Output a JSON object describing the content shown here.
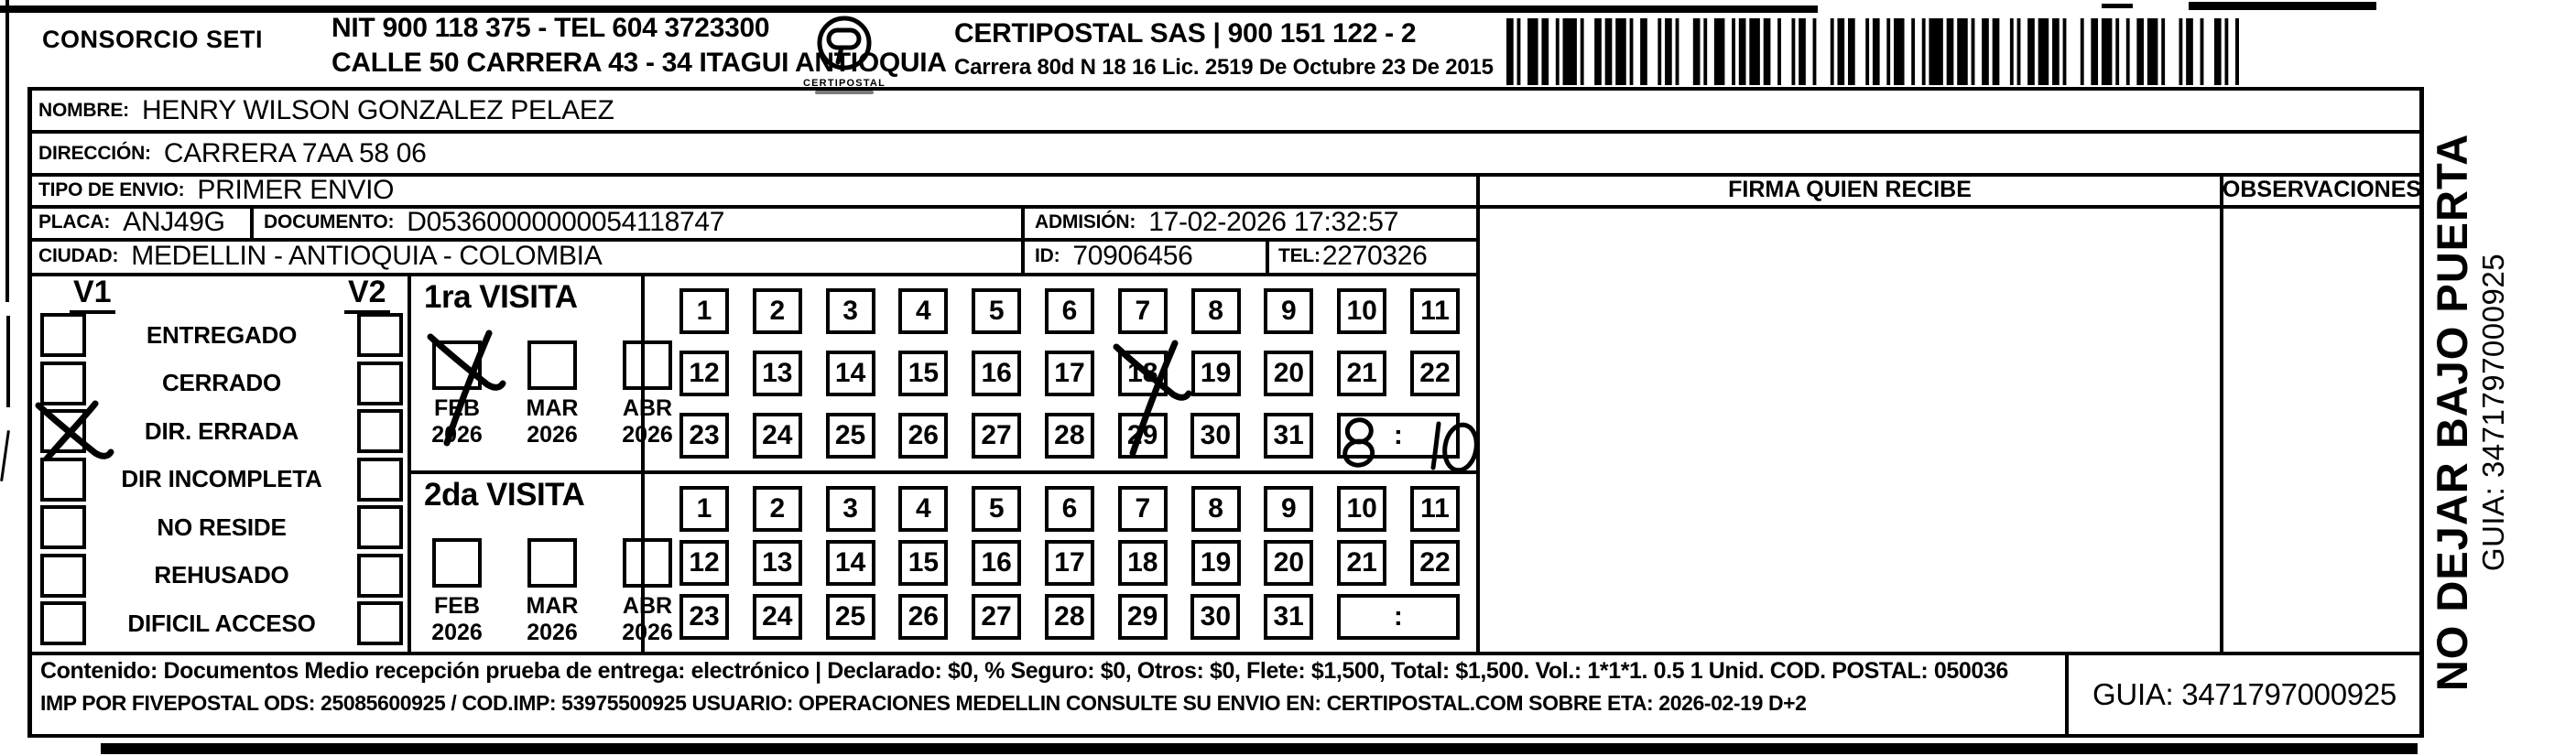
{
  "header": {
    "consorcio": "CONSORCIO SETI",
    "nit_line": "NIT 900 118 375 - TEL 604 3723300",
    "calle_line": "CALLE 50 CARRERA 43 - 34 ITAGUI ANTIOQUIA",
    "logo_caption": "CERTIPOSTAL",
    "certipostal_line": "CERTIPOSTAL SAS | 900 151 122 - 2",
    "licencia_line": "Carrera 80d N 18 16  Lic. 2519 De Octubre 23 De 2015"
  },
  "recipient": {
    "nombre_label": "NOMBRE:",
    "nombre": "HENRY WILSON GONZALEZ PELAEZ",
    "direccion_label": "DIRECCIÓN:",
    "direccion": "CARRERA 7AA 58 06",
    "tipo_envio_label": "TIPO DE ENVIO:",
    "tipo_envio": "PRIMER ENVIO",
    "placa_label": "PLACA:",
    "placa": "ANJ49G",
    "documento_label": "DOCUMENTO:",
    "documento": "D05360000000054118747",
    "admision_label": "ADMISIÓN:",
    "admision": "17-02-2026 17:32:57",
    "ciudad_label": "CIUDAD:",
    "ciudad": "MEDELLIN - ANTIOQUIA - COLOMBIA",
    "id_label": "ID:",
    "id": "70906456",
    "tel_label": "TEL:",
    "tel": "2270326"
  },
  "signature": {
    "firma_header": "FIRMA QUIEN RECIBE",
    "observaciones_header": "OBSERVACIONES"
  },
  "status_panel": {
    "col1": "V1",
    "col2": "V2",
    "rows": [
      {
        "label": "ENTREGADO",
        "v1": false,
        "v2": false
      },
      {
        "label": "CERRADO",
        "v1": false,
        "v2": false
      },
      {
        "label": "DIR. ERRADA",
        "v1": true,
        "v2": false
      },
      {
        "label": "DIR INCOMPLETA",
        "v1": false,
        "v2": false
      },
      {
        "label": "NO RESIDE",
        "v1": false,
        "v2": false
      },
      {
        "label": "REHUSADO",
        "v1": false,
        "v2": false
      },
      {
        "label": "DIFICIL ACCESO",
        "v1": false,
        "v2": false
      }
    ]
  },
  "visits": [
    {
      "title": "1ra VISITA",
      "months": [
        {
          "label": "FEB",
          "year": "2026",
          "checked": true
        },
        {
          "label": "MAR",
          "year": "2026",
          "checked": false
        },
        {
          "label": "ABR",
          "year": "2026",
          "checked": false
        }
      ],
      "day_rows": [
        [
          1,
          2,
          3,
          4,
          5,
          6,
          7,
          8,
          9,
          10,
          11
        ],
        [
          12,
          13,
          14,
          15,
          16,
          17,
          18,
          19,
          20,
          21,
          22
        ],
        [
          23,
          24,
          25,
          26,
          27,
          28,
          29,
          30,
          31
        ]
      ],
      "crossed_day": 18,
      "time_separator": ":",
      "time_written": "8:10"
    },
    {
      "title": "2da VISITA",
      "months": [
        {
          "label": "FEB",
          "year": "2026",
          "checked": false
        },
        {
          "label": "MAR",
          "year": "2026",
          "checked": false
        },
        {
          "label": "ABR",
          "year": "2026",
          "checked": false
        }
      ],
      "day_rows": [
        [
          1,
          2,
          3,
          4,
          5,
          6,
          7,
          8,
          9,
          10,
          11
        ],
        [
          12,
          13,
          14,
          15,
          16,
          17,
          18,
          19,
          20,
          21,
          22
        ],
        [
          23,
          24,
          25,
          26,
          27,
          28,
          29,
          30,
          31
        ]
      ],
      "crossed_day": null,
      "time_separator": ":",
      "time_written": ""
    }
  ],
  "footer": {
    "line1": "Contenido: Documentos Medio recepción prueba de entrega: electrónico | Declarado: $0, % Seguro: $0, Otros: $0, Flete: $1,500, Total: $1,500. Vol.: 1*1*1. 0.5  1 Unid. COD. POSTAL: 050036",
    "line2": "IMP POR FIVEPOSTAL ODS: 25085600925 / COD.IMP: 53975500925 USUARIO: OPERACIONES MEDELLIN CONSULTE SU ENVIO EN: CERTIPOSTAL.COM SOBRE ETA: 2026-02-19 D+2",
    "guia": "GUIA: 3471797000925"
  },
  "side_note": {
    "warning": "NO DEJAR BAJO PUERTA",
    "guia": "GUIA: 3471797000925"
  }
}
